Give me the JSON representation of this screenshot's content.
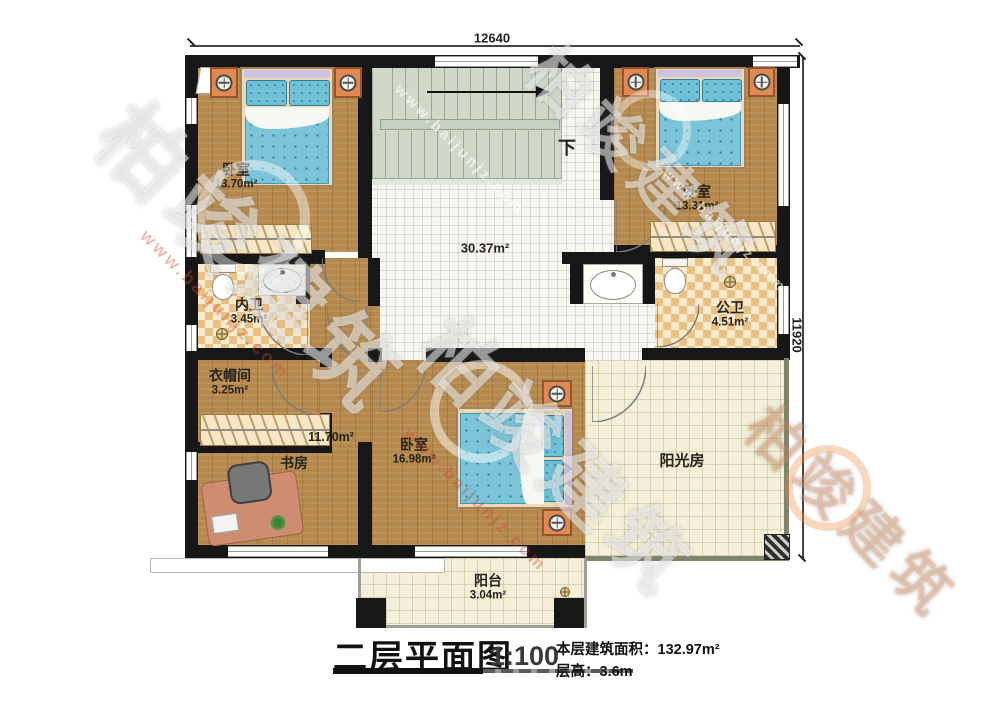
{
  "dimensions": {
    "top": "12640",
    "right": "11920"
  },
  "stairs": {
    "down": "下"
  },
  "rooms": [
    {
      "name": "卧室",
      "area": "13.70m²"
    },
    {
      "name": "卧室",
      "area": "13.31m²"
    },
    {
      "name": "",
      "area": "30.37m²"
    },
    {
      "name": "内卫",
      "area": "3.45m²"
    },
    {
      "name": "公卫",
      "area": "4.51m²"
    },
    {
      "name": "衣帽间",
      "area": "3.25m²"
    },
    {
      "name": "书房",
      "area": "11.70m²"
    },
    {
      "name": "卧室",
      "area": "16.98m²"
    },
    {
      "name": "阳光房",
      "area": ""
    },
    {
      "name": "阳台",
      "area": "3.04m²"
    }
  ],
  "title_block": {
    "title": "二层平面图",
    "scale": "1:100",
    "area_line": "本层建筑面积：132.97m²",
    "height_line": "层高：3.6m"
  },
  "watermark": {
    "brand": "柏竣建筑",
    "url": "www.baijunjz.com"
  },
  "colors": {
    "wall": "#171717",
    "wood": "#b5894e",
    "bed_blue": "#7cc4d8",
    "checker_tan": "#e9c184"
  }
}
